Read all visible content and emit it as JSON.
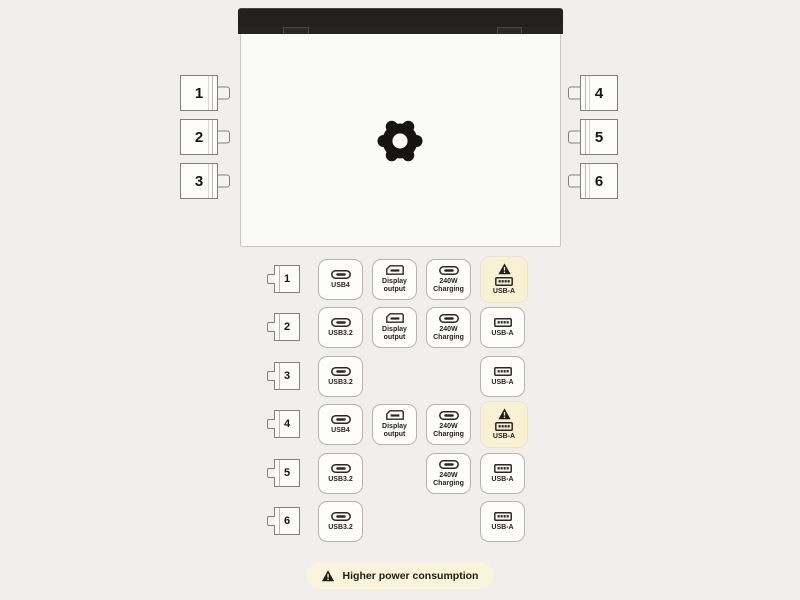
{
  "colors": {
    "background": "#f0efed",
    "laptop_lid": "#232020",
    "laptop_body": "#fafaf8",
    "module_border": "#83817d",
    "badge_border": "#b7b4ae",
    "warning_highlight": "#f8f1d3",
    "legend_background": "#faf5da",
    "ink": "#1c1a17"
  },
  "laptop": {
    "logo_icon": "framework-gear-icon"
  },
  "side_modules": {
    "left": [
      {
        "label": "1"
      },
      {
        "label": "2"
      },
      {
        "label": "3"
      }
    ],
    "right": [
      {
        "label": "4"
      },
      {
        "label": "5"
      },
      {
        "label": "6"
      }
    ]
  },
  "matrix": {
    "rows": [
      {
        "port": "1",
        "badges": [
          {
            "label": "USB4",
            "icon": "usb-c-icon",
            "col": 0,
            "warning": false
          },
          {
            "label": "Display output",
            "icon": "displayport-icon",
            "col": 1,
            "warning": false
          },
          {
            "label": "240W Charging",
            "icon": "usb-c-icon",
            "col": 2,
            "warning": false
          },
          {
            "label": "USB-A",
            "icon": "usb-a-icon",
            "col": 3,
            "warning": true
          }
        ]
      },
      {
        "port": "2",
        "badges": [
          {
            "label": "USB3.2",
            "icon": "usb-c-icon",
            "col": 0,
            "warning": false
          },
          {
            "label": "Display output",
            "icon": "displayport-icon",
            "col": 1,
            "warning": false
          },
          {
            "label": "240W Charging",
            "icon": "usb-c-icon",
            "col": 2,
            "warning": false
          },
          {
            "label": "USB-A",
            "icon": "usb-a-icon",
            "col": 3,
            "warning": false
          }
        ]
      },
      {
        "port": "3",
        "badges": [
          {
            "label": "USB3.2",
            "icon": "usb-c-icon",
            "col": 0,
            "warning": false
          },
          {
            "label": "USB-A",
            "icon": "usb-a-icon",
            "col": 3,
            "warning": false
          }
        ]
      },
      {
        "port": "4",
        "badges": [
          {
            "label": "USB4",
            "icon": "usb-c-icon",
            "col": 0,
            "warning": false
          },
          {
            "label": "Display output",
            "icon": "displayport-icon",
            "col": 1,
            "warning": false
          },
          {
            "label": "240W Charging",
            "icon": "usb-c-icon",
            "col": 2,
            "warning": false
          },
          {
            "label": "USB-A",
            "icon": "usb-a-icon",
            "col": 3,
            "warning": true
          }
        ]
      },
      {
        "port": "5",
        "badges": [
          {
            "label": "USB3.2",
            "icon": "usb-c-icon",
            "col": 0,
            "warning": false
          },
          {
            "label": "240W Charging",
            "icon": "usb-c-icon",
            "col": 2,
            "warning": false
          },
          {
            "label": "USB-A",
            "icon": "usb-a-icon",
            "col": 3,
            "warning": false
          }
        ]
      },
      {
        "port": "6",
        "badges": [
          {
            "label": "USB3.2",
            "icon": "usb-c-icon",
            "col": 0,
            "warning": false
          },
          {
            "label": "USB-A",
            "icon": "usb-a-icon",
            "col": 3,
            "warning": false
          }
        ]
      }
    ]
  },
  "legend": {
    "icon": "warning-icon",
    "label": "Higher power consumption"
  }
}
